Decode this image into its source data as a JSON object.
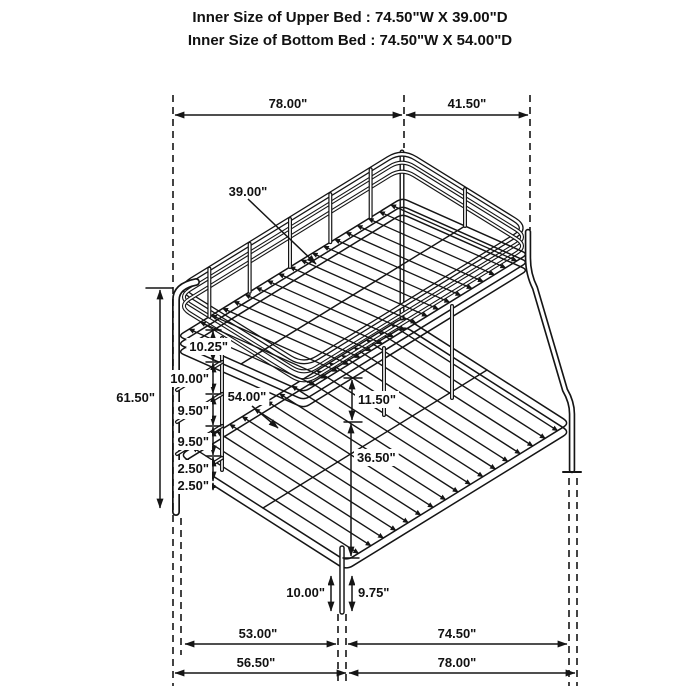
{
  "page": {
    "background": "#ffffff",
    "line_color": "#151515"
  },
  "header": {
    "line1": "Inner Size of Upper Bed : 74.50\"W X 39.00\"D",
    "line2": "Inner Size of Bottom Bed : 74.50\"W X 54.00\"D"
  },
  "dimension_labels": [
    {
      "name": "dim-top-width",
      "text": "78.00\"",
      "x": 288,
      "y": 108,
      "anchor": "middle",
      "bg": false
    },
    {
      "name": "dim-top-depth",
      "text": "41.50\"",
      "x": 467,
      "y": 108,
      "anchor": "middle",
      "bg": false
    },
    {
      "name": "dim-overall-height",
      "text": "61.50\"",
      "x": 155,
      "y": 402,
      "anchor": "end",
      "bg": false
    },
    {
      "name": "dim-upper-bed-depth",
      "text": "39.00\"",
      "x": 248,
      "y": 196,
      "anchor": "middle",
      "bg": false
    },
    {
      "name": "dim-ladder-space-1",
      "text": "10.25\"",
      "x": 228,
      "y": 351,
      "anchor": "end",
      "bg": true
    },
    {
      "name": "dim-ladder-space-2",
      "text": "10.00\"",
      "x": 209,
      "y": 383,
      "anchor": "end",
      "bg": true
    },
    {
      "name": "dim-ladder-space-3",
      "text": "9.50\"",
      "x": 209,
      "y": 415,
      "anchor": "end",
      "bg": true
    },
    {
      "name": "dim-ladder-space-4",
      "text": "9.50\"",
      "x": 209,
      "y": 446,
      "anchor": "end",
      "bg": true
    },
    {
      "name": "dim-ladder-space-5",
      "text": "2.50\"",
      "x": 209,
      "y": 473,
      "anchor": "end",
      "bg": true
    },
    {
      "name": "dim-ladder-space-6",
      "text": "2.50\"",
      "x": 209,
      "y": 490,
      "anchor": "end",
      "bg": true
    },
    {
      "name": "dim-lower-bed-depth",
      "text": "54.00\"",
      "x": 247,
      "y": 401,
      "anchor": "middle",
      "bg": true
    },
    {
      "name": "dim-bunk-gap",
      "text": "11.50\"",
      "x": 358,
      "y": 404,
      "anchor": "start",
      "bg": true
    },
    {
      "name": "dim-lower-bed-height",
      "text": "36.50\"",
      "x": 357,
      "y": 462,
      "anchor": "start",
      "bg": true
    },
    {
      "name": "dim-floor-clearance-left",
      "text": "10.00\"",
      "x": 325,
      "y": 597,
      "anchor": "end",
      "bg": true
    },
    {
      "name": "dim-floor-clearance-right",
      "text": "9.75\"",
      "x": 358,
      "y": 597,
      "anchor": "start",
      "bg": true
    },
    {
      "name": "dim-bottom-inner-depth",
      "text": "53.00\"",
      "x": 258,
      "y": 638,
      "anchor": "middle",
      "bg": false
    },
    {
      "name": "dim-bottom-inner-width",
      "text": "74.50\"",
      "x": 457,
      "y": 638,
      "anchor": "middle",
      "bg": false
    },
    {
      "name": "dim-bottom-outer-depth",
      "text": "56.50\"",
      "x": 256,
      "y": 667,
      "anchor": "middle",
      "bg": false
    },
    {
      "name": "dim-bottom-outer-width",
      "text": "78.00\"",
      "x": 457,
      "y": 667,
      "anchor": "middle",
      "bg": false
    }
  ]
}
